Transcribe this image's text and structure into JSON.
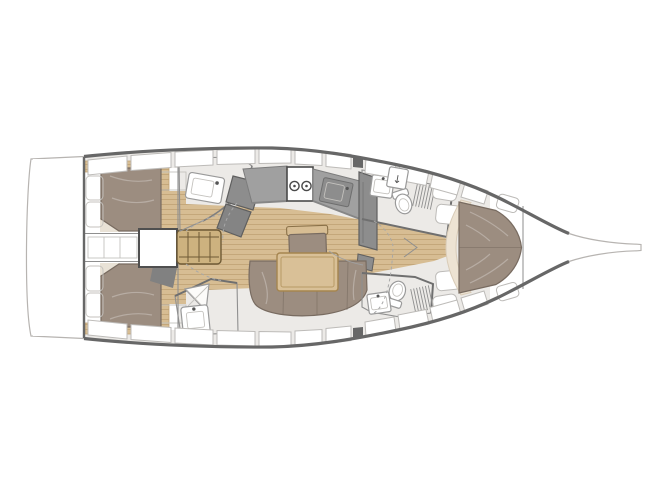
{
  "palette": {
    "bg": "#ffffff",
    "hull": "#ffffff",
    "hullStroke": "#b7b4b1",
    "sheer": "#676767",
    "deck": "#eceae7",
    "hatchStroke": "#bdbbb8",
    "white": "#ffffff",
    "roomFloor": "#f2f0ec",
    "wall": "#8f8f8f",
    "wood": "#d7bd93",
    "woodLine": "#c0a274",
    "table": "#d9c097",
    "steps": "#cdb27f",
    "counter": "#a0a0a0",
    "module": "#8d8d8d",
    "module2": "#848484",
    "cushion": "#9c8d80",
    "cushionStroke": "#786b60",
    "cream": "#ede3d3",
    "pillow": "#fcfbf9"
  },
  "glyphs": {
    "hatch_arrow": "↓"
  }
}
